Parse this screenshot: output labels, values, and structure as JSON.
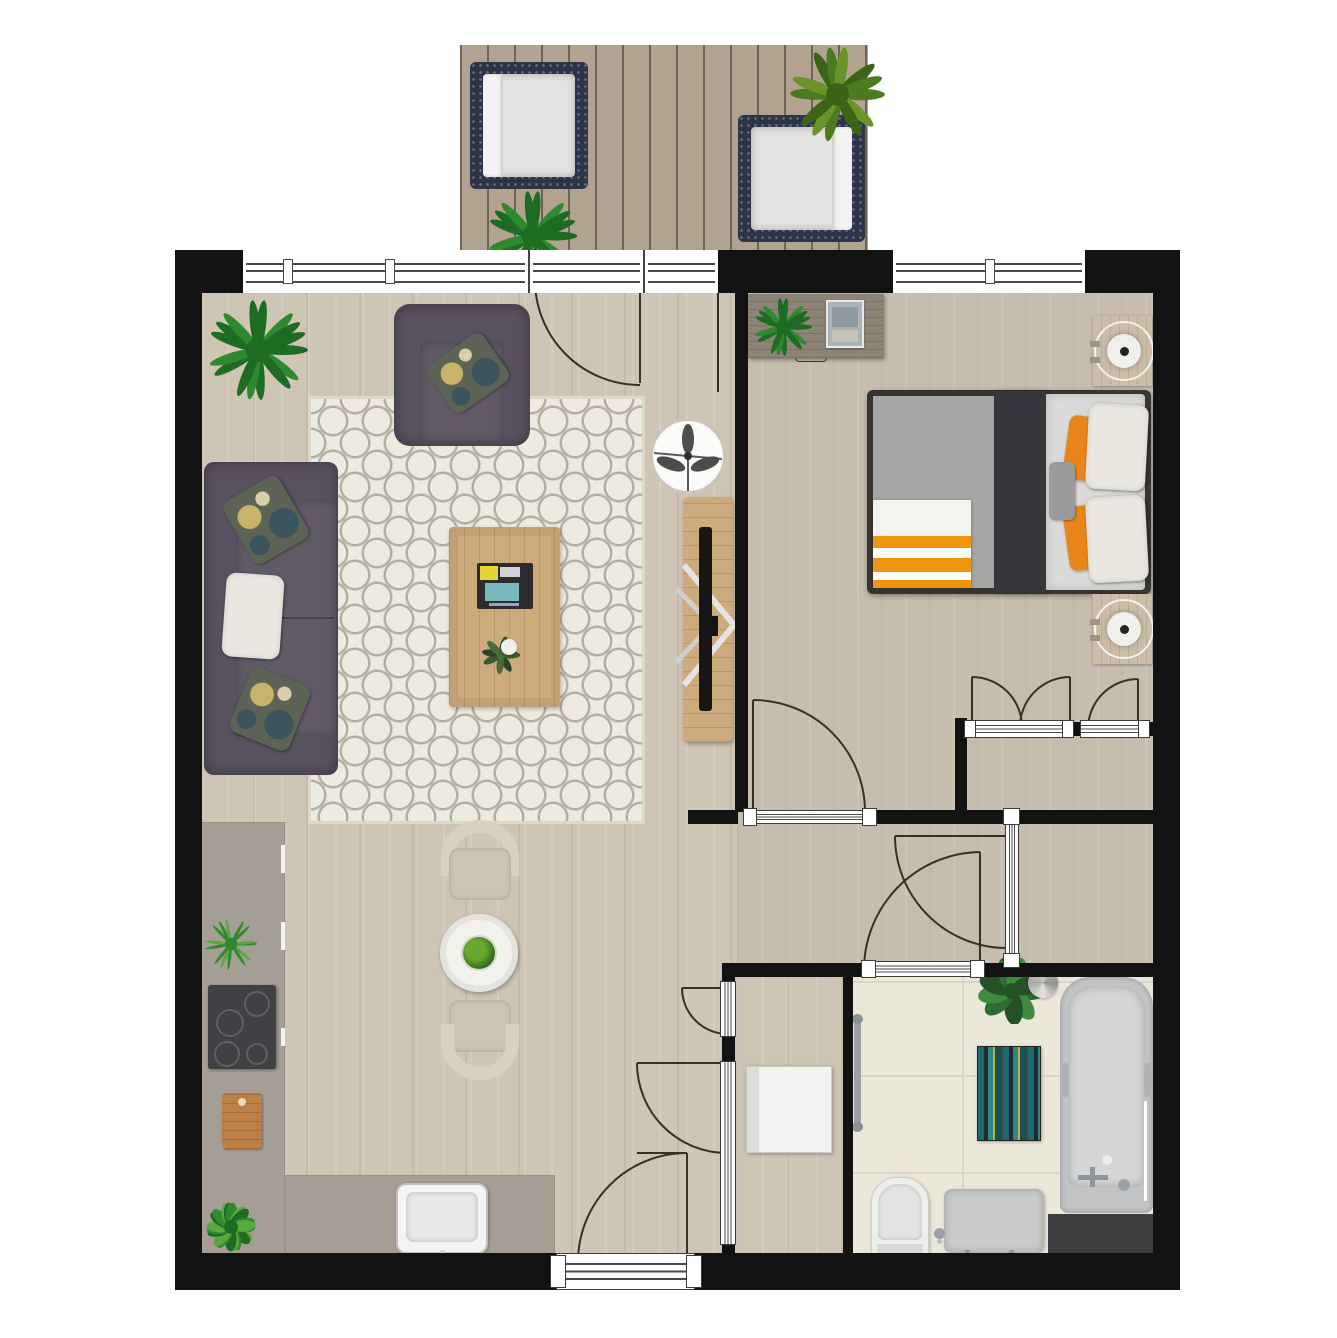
{
  "meta": {
    "title": "one-bedroom-apartment-floor-plan",
    "canvas_width": 1337,
    "canvas_height": 1338,
    "visible_text": "none"
  },
  "palette": {
    "wall": "#121212",
    "floorLiving": "#cfc5b4",
    "floorBedroom": "#c6bdaf",
    "tile": "#ebe7d9",
    "tileLine": "#dad5c4",
    "deck": "#b2a390",
    "deckLine": "#6e6456",
    "counter": "#a49e95",
    "rugBase": "#edebdf",
    "rugLine": "#b0b1a4",
    "sofa": "#585260",
    "sofaSeat": "#615b68",
    "pillowWhite": "#e9e7e0",
    "paisleyGold": "#c9b36a",
    "paisleyTeal": "#39545c",
    "woodTable": "#cdab7c",
    "tray": "#2c2c2e",
    "tv": "#161616",
    "fanBlade": "#4c4c4a",
    "bedFrame": "#383430",
    "mattress": "#a8a7a5",
    "blanket": "#36373a",
    "duvet": "#dadad8",
    "orange": "#e8861c",
    "throwOrange": "#f0930f",
    "lampWood": "#cbbda7",
    "deskWood": "#8d8477",
    "green1": "#1e6b24",
    "green2": "#2f8a2f",
    "green3": "#5aa93e",
    "cooktop": "#404144",
    "board": "#bc8046",
    "sinkWhite": "#f4f4f2",
    "chair": "#d6d1c2",
    "chairSeat": "#cbc6b6",
    "tableWhite": "#f2f1ed",
    "tub": "#c2c4c6",
    "tubInner": "#d4d6d8",
    "mat": "#3e3e40",
    "toilet": "#edefec",
    "vanity": "#c9cbca",
    "chrome": "#9aa0a3",
    "navy": "#2e3447",
    "cushion": "#e3e3e1",
    "doorArc": "#3a2f26"
  },
  "floor_plan": {
    "rooms": [
      {
        "name": "balcony",
        "items": [
          "lounge-chair",
          "lounge-chair",
          "palm-plant",
          "fern-plant"
        ]
      },
      {
        "name": "living-room",
        "items": [
          "sofa",
          "armchair",
          "area-rug",
          "coffee-table",
          "magazine-tray",
          "tv-console",
          "tv",
          "ceiling-fan",
          "fern-plant"
        ]
      },
      {
        "name": "kitchen-dining",
        "items": [
          "l-shaped-counter",
          "cooktop",
          "kitchen-sink",
          "cutting-board",
          "herb-plant",
          "shrub-plant",
          "dining-table",
          "dining-chair",
          "dining-chair",
          "table-plant"
        ]
      },
      {
        "name": "bedroom",
        "items": [
          "double-bed",
          "striped-throw",
          "nightstand",
          "nightstand",
          "table-lamp",
          "table-lamp",
          "desk",
          "desk-plant",
          "photo-frame"
        ]
      },
      {
        "name": "closet",
        "items": [
          "double-folding-door",
          "single-door"
        ]
      },
      {
        "name": "hallway",
        "items": []
      },
      {
        "name": "storage-room",
        "items": [
          "washing-machine"
        ]
      },
      {
        "name": "bathroom",
        "items": [
          "bathtub",
          "toilet",
          "vanity-sink",
          "towel-rail",
          "monstera-plant",
          "striped-rug",
          "shower-mat",
          "shell-ornament"
        ]
      }
    ],
    "doors": [
      "balcony-door",
      "bedroom-door",
      "closet-double-door",
      "closet-single-door",
      "hallway-door",
      "bathroom-door",
      "storage-upper-door",
      "storage-lower-door",
      "entrance-door"
    ],
    "windows": [
      "living-room-window",
      "balcony-side-pane",
      "bedroom-window"
    ]
  }
}
